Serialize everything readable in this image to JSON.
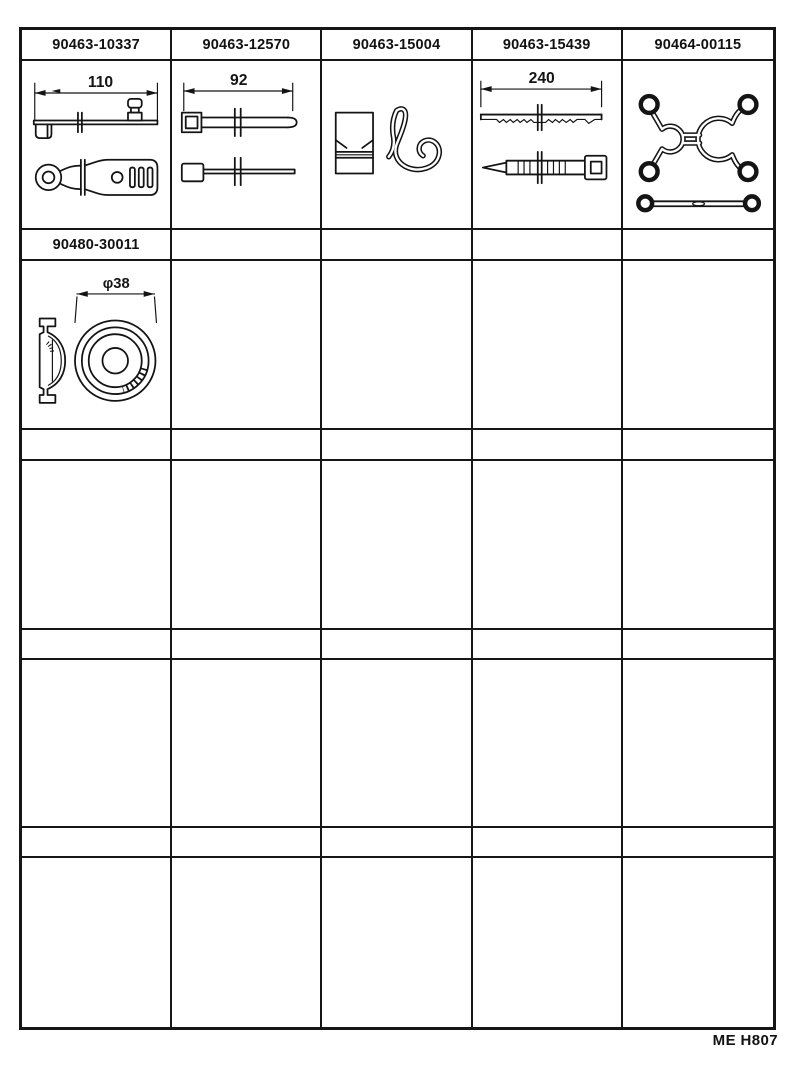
{
  "footer": {
    "code": "ME H807"
  },
  "catalog": {
    "row1": {
      "cells": [
        {
          "part_number": "90463-10337",
          "dimension": "110"
        },
        {
          "part_number": "90463-12570",
          "dimension": "92"
        },
        {
          "part_number": "90463-15004",
          "dimension": ""
        },
        {
          "part_number": "90463-15439",
          "dimension": "240"
        },
        {
          "part_number": "90464-00115",
          "dimension": ""
        }
      ]
    },
    "row2": {
      "cells": [
        {
          "part_number": "90480-30011",
          "dimension": "φ38"
        }
      ]
    }
  }
}
